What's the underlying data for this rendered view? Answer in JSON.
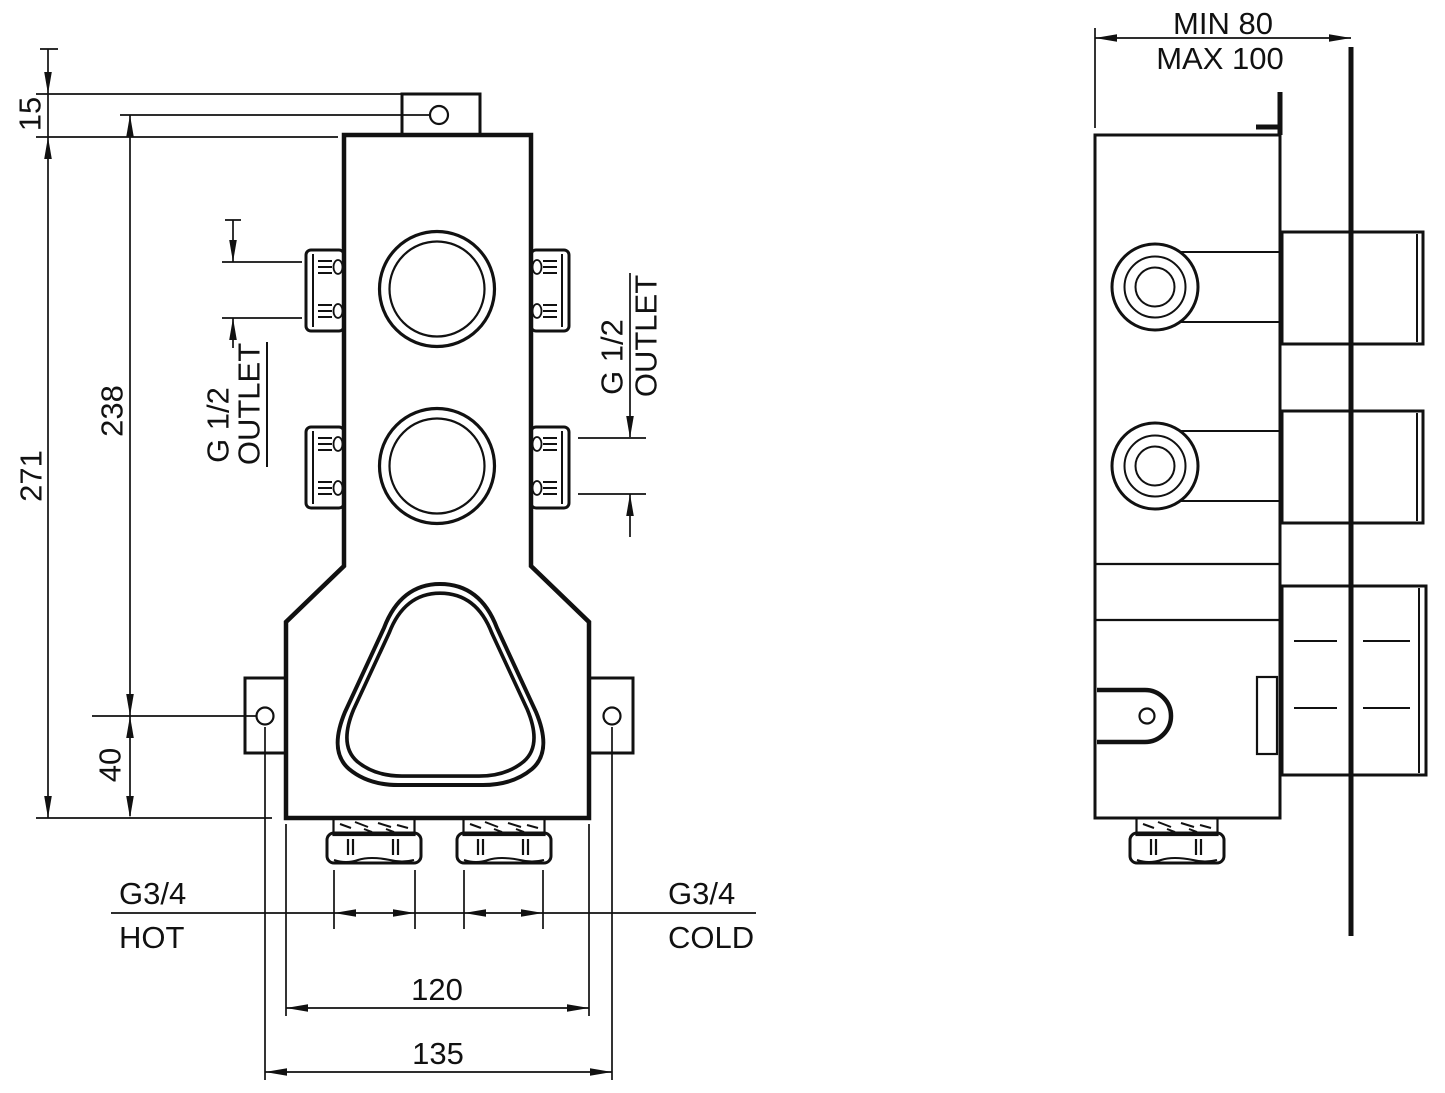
{
  "drawing_type": "technical installation drawing, concealed thermostatic shower valve, front and side views",
  "colors": {
    "ink": "#111111",
    "background": "#ffffff"
  },
  "front_view": {
    "labels": {
      "tab_offset": "15",
      "overall_height": "271",
      "tab_hole_to_fixing_holes": "238",
      "fixing_hole_to_bottom": "40",
      "body_bottom_width": "120",
      "fixing_hole_spacing": "135",
      "outlet_left": {
        "thread": "G 1/2",
        "word": "OUTLET"
      },
      "outlet_right": {
        "thread": "G 1/2",
        "word": "OUTLET"
      },
      "inlet_hot": {
        "thread": "G3/4",
        "word": "HOT"
      },
      "inlet_cold": {
        "thread": "G3/4",
        "word": "COLD"
      }
    }
  },
  "side_view": {
    "labels": {
      "recess_depth_min": "MIN 80",
      "recess_depth_max": "MAX 100"
    }
  }
}
